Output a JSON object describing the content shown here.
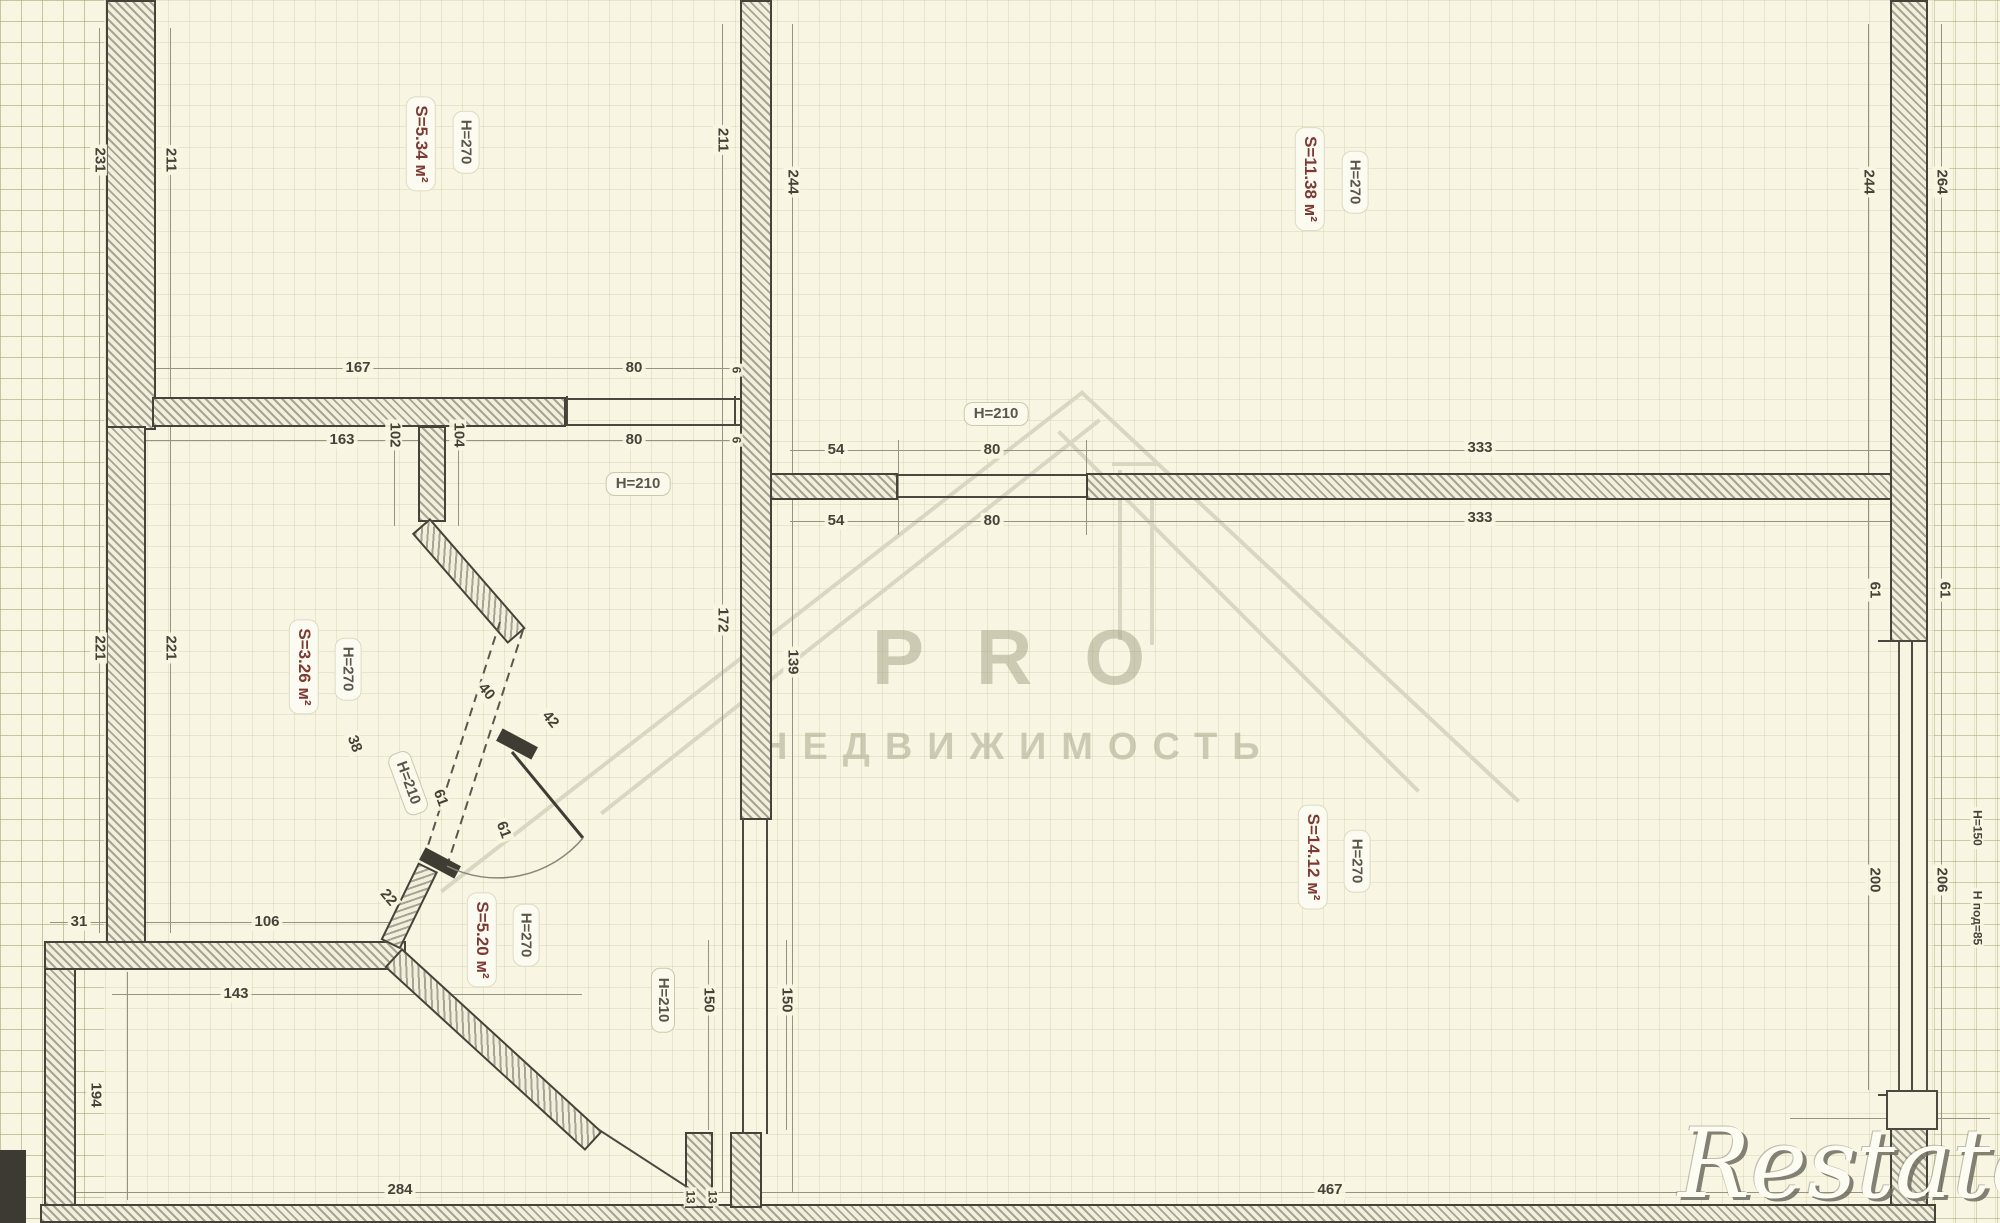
{
  "watermark": {
    "top": "PRO",
    "bottom": "НЕДВИЖИМОСТЬ"
  },
  "logo_text": "Restate",
  "colors": {
    "paper": "#f8f6e2",
    "wall_outline": "#45423a",
    "area_text": "#7c3a33",
    "dim_text": "#46423a",
    "watermark": "#d9d7c2"
  },
  "plan": {
    "rooms": [
      {
        "area": "S=5.34 м²",
        "height": "H=270"
      },
      {
        "area": "S=11.38 м²",
        "height": "H=270"
      },
      {
        "area": "S=3.26 м²",
        "height": "H=270"
      },
      {
        "area": "S=5.20 м²",
        "height": "H=270"
      },
      {
        "area": "S=14.12 м²",
        "height": "H=270"
      }
    ],
    "opening_height_tags": [
      {
        "text": "H=210",
        "x": 996,
        "y": 414,
        "rot": 0
      },
      {
        "text": "H=210",
        "x": 638,
        "y": 484,
        "rot": 0
      },
      {
        "text": "H=210",
        "x": 663,
        "y": 1000,
        "rot": 90
      },
      {
        "text": "H=210",
        "x": 408,
        "y": 783,
        "rot": 70
      }
    ],
    "dim_labels": [
      {
        "text": "231",
        "x": 99,
        "y": 160,
        "rot": 90
      },
      {
        "text": "211",
        "x": 170,
        "y": 160,
        "rot": 90
      },
      {
        "text": "221",
        "x": 99,
        "y": 648,
        "rot": 90
      },
      {
        "text": "221",
        "x": 170,
        "y": 648,
        "rot": 90
      },
      {
        "text": "211",
        "x": 722,
        "y": 140,
        "rot": 90
      },
      {
        "text": "244",
        "x": 792,
        "y": 182,
        "rot": 90
      },
      {
        "text": "172",
        "x": 722,
        "y": 620,
        "rot": 90
      },
      {
        "text": "139",
        "x": 792,
        "y": 662,
        "rot": 90
      },
      {
        "text": "244",
        "x": 1868,
        "y": 182,
        "rot": 90
      },
      {
        "text": "264",
        "x": 1941,
        "y": 182,
        "rot": 90
      },
      {
        "text": "61",
        "x": 1874,
        "y": 590,
        "rot": 90
      },
      {
        "text": "61",
        "x": 1944,
        "y": 590,
        "rot": 90
      },
      {
        "text": "200",
        "x": 1874,
        "y": 880,
        "rot": 90
      },
      {
        "text": "206",
        "x": 1941,
        "y": 880,
        "rot": 90
      },
      {
        "text": "H=150",
        "x": 1977,
        "y": 828,
        "rot": 90,
        "cls": "small"
      },
      {
        "text": "Н под=85",
        "x": 1977,
        "y": 918,
        "rot": 90,
        "cls": "small"
      },
      {
        "text": "102",
        "x": 394,
        "y": 435,
        "rot": 90
      },
      {
        "text": "104",
        "x": 458,
        "y": 435,
        "rot": 90
      },
      {
        "text": "194",
        "x": 95,
        "y": 1095,
        "rot": 90
      },
      {
        "text": "150",
        "x": 708,
        "y": 1000,
        "rot": 90
      },
      {
        "text": "150",
        "x": 786,
        "y": 1000,
        "rot": 90
      },
      {
        "text": "13",
        "x": 690,
        "y": 1197,
        "rot": 90,
        "cls": "small"
      },
      {
        "text": "13",
        "x": 712,
        "y": 1197,
        "rot": 90,
        "cls": "small"
      },
      {
        "text": "6",
        "x": 736,
        "y": 370,
        "rot": 90,
        "cls": "small"
      },
      {
        "text": "6",
        "x": 736,
        "y": 440,
        "rot": 90,
        "cls": "small"
      },
      {
        "text": "167",
        "x": 358,
        "y": 368,
        "rot": 0
      },
      {
        "text": "80",
        "x": 634,
        "y": 368,
        "rot": 0
      },
      {
        "text": "163",
        "x": 342,
        "y": 440,
        "rot": 0
      },
      {
        "text": "80",
        "x": 634,
        "y": 440,
        "rot": 0
      },
      {
        "text": "54",
        "x": 836,
        "y": 450,
        "rot": 0
      },
      {
        "text": "80",
        "x": 992,
        "y": 450,
        "rot": 0
      },
      {
        "text": "333",
        "x": 1480,
        "y": 448,
        "rot": 0
      },
      {
        "text": "54",
        "x": 836,
        "y": 521,
        "rot": 0
      },
      {
        "text": "80",
        "x": 992,
        "y": 521,
        "rot": 0
      },
      {
        "text": "333",
        "x": 1480,
        "y": 518,
        "rot": 0
      },
      {
        "text": "31",
        "x": 79,
        "y": 922,
        "rot": 0
      },
      {
        "text": "106",
        "x": 267,
        "y": 922,
        "rot": 0
      },
      {
        "text": "143",
        "x": 236,
        "y": 994,
        "rot": 0
      },
      {
        "text": "284",
        "x": 400,
        "y": 1190,
        "rot": 0
      },
      {
        "text": "467",
        "x": 1330,
        "y": 1190,
        "rot": 0
      },
      {
        "text": "40",
        "x": 486,
        "y": 692,
        "rot": 50
      },
      {
        "text": "42",
        "x": 550,
        "y": 720,
        "rot": 50
      },
      {
        "text": "61",
        "x": 440,
        "y": 798,
        "rot": 70
      },
      {
        "text": "61",
        "x": 503,
        "y": 830,
        "rot": 70
      },
      {
        "text": "22",
        "x": 388,
        "y": 898,
        "rot": 50
      },
      {
        "text": "38",
        "x": 354,
        "y": 744,
        "rot": 70
      }
    ]
  }
}
